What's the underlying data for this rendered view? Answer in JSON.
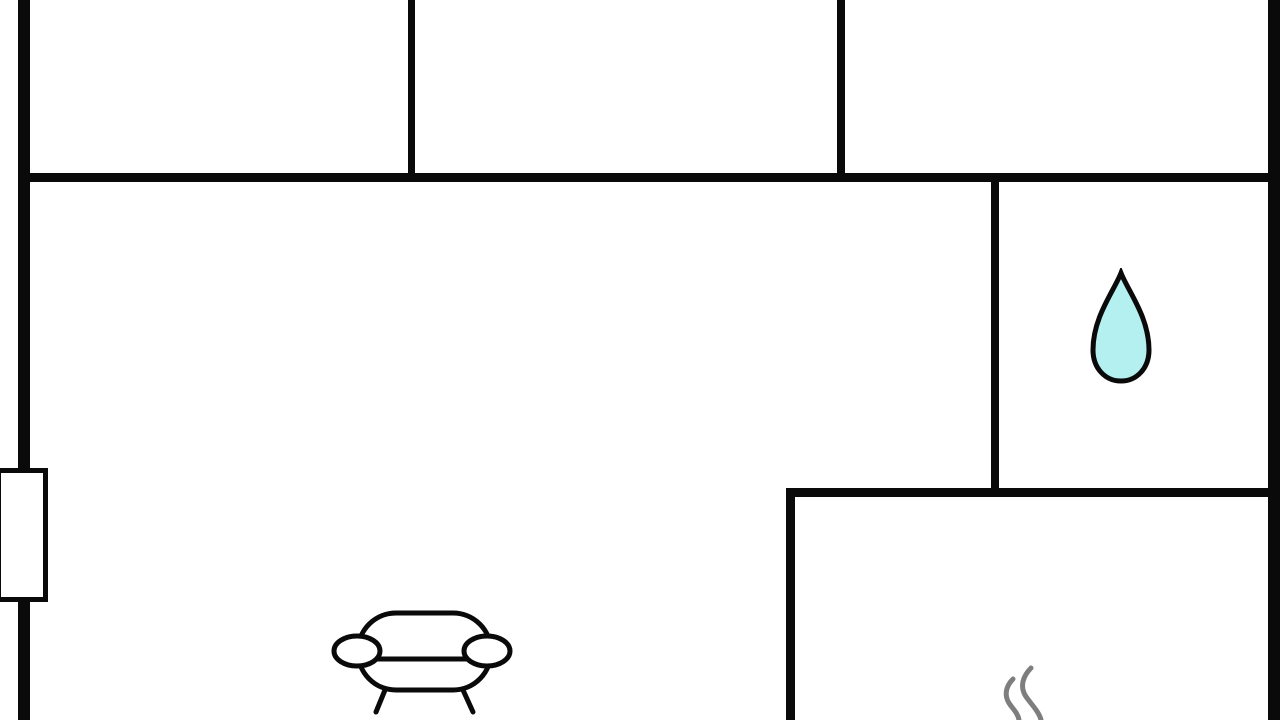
{
  "scene": {
    "type": "floor-plan",
    "description": "black-outline apartment floor plan, no text labels",
    "background": "#ffffff"
  },
  "colors": {
    "background": "#ffffff",
    "wall": "#0a0a0a",
    "icon_outline": "#0a0a0a",
    "drop_fill": "#b5f0f1",
    "sofa_fill": "#ffffff",
    "steam": "#7e7e7e",
    "window_fill": "#ffffff"
  },
  "icons": [
    {
      "name": "water-drop-icon",
      "fill": "#b5f0f1",
      "outline": "#0a0a0a"
    },
    {
      "name": "sofa-icon",
      "fill": "#ffffff",
      "outline": "#0a0a0a"
    },
    {
      "name": "steam-icon",
      "stroke": "#7e7e7e"
    }
  ],
  "markers": [
    {
      "name": "window-marker",
      "wall": "left-exterior"
    }
  ]
}
